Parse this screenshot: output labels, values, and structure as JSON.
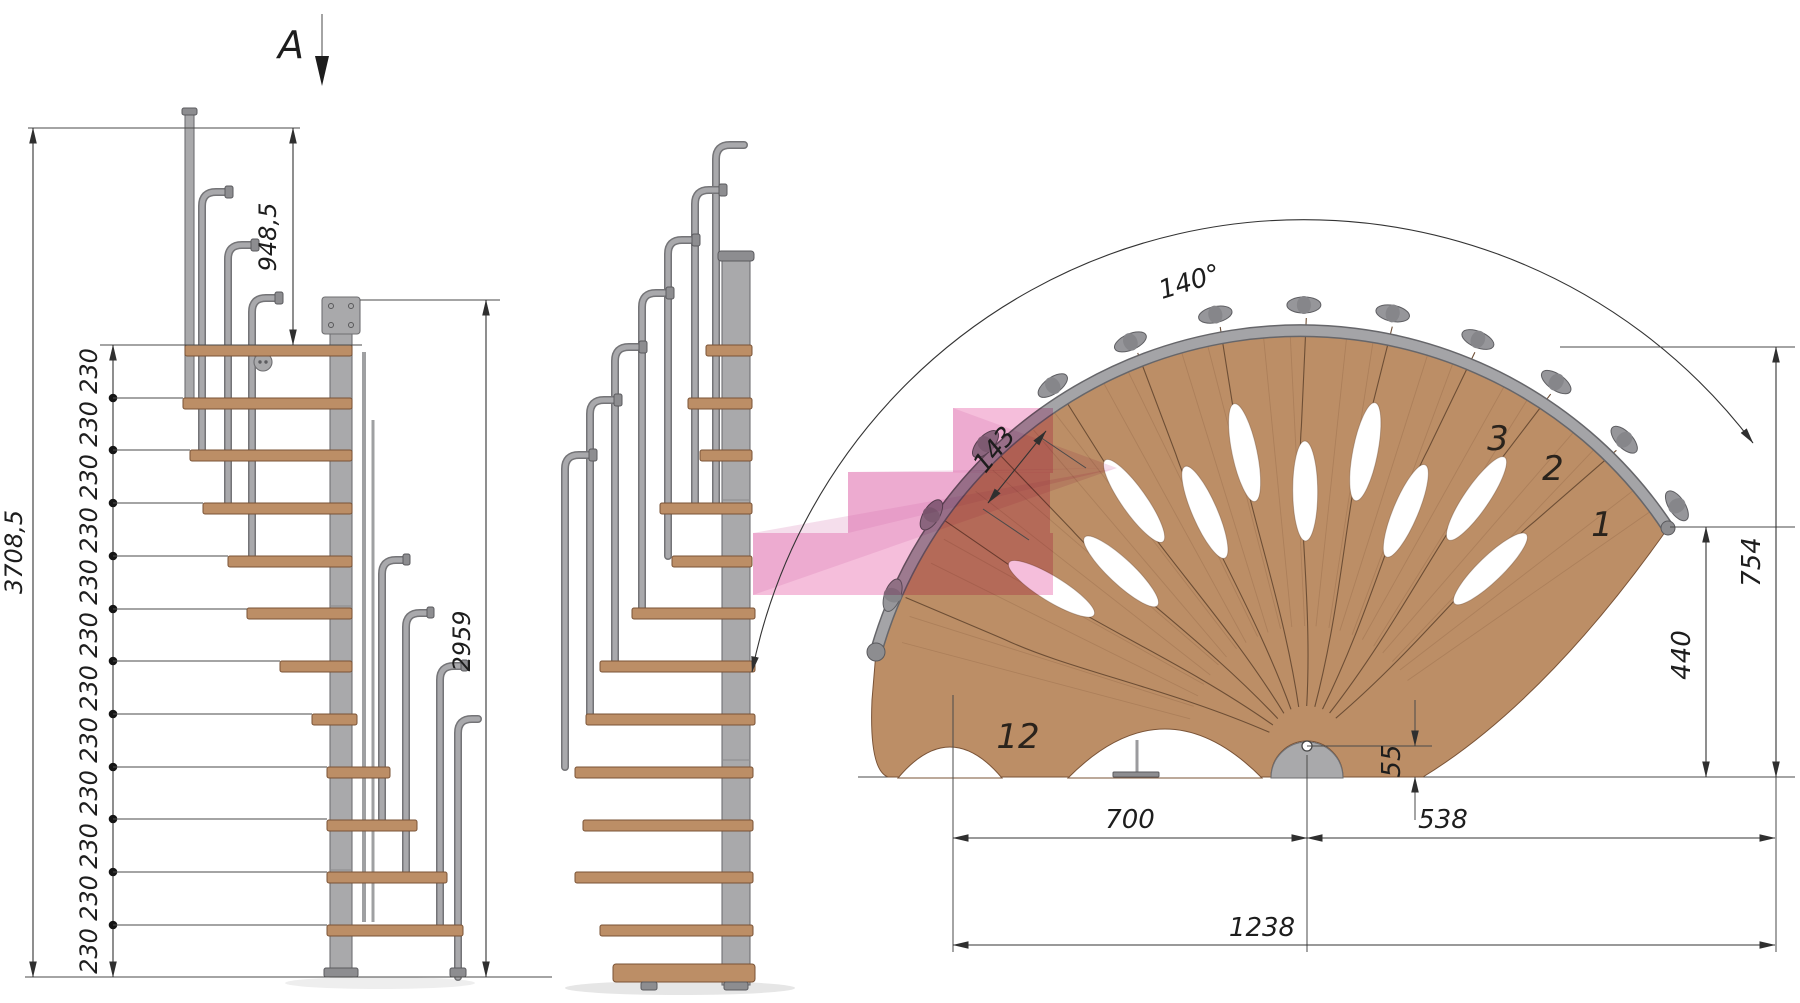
{
  "section_marker": {
    "label": "A"
  },
  "side_view": {
    "overall_height": "3708,5",
    "top_run_height": "948,5",
    "pole_height": "2959",
    "risers": [
      "230",
      "230",
      "230",
      "230",
      "230",
      "230",
      "230",
      "230",
      "230",
      "230",
      "230",
      "230"
    ]
  },
  "plan_view": {
    "rotation_angle": "140°",
    "step_outer_width": "143",
    "outer_radius": "754",
    "tread_depth": "440",
    "pole_offset": "55",
    "left_width": "700",
    "right_width": "538",
    "total_width": "1238",
    "step_numbers": {
      "first": "1",
      "second": "2",
      "third": "3",
      "last": "12"
    }
  },
  "colors": {
    "wood": "#bc8e66",
    "wood_edge": "#7a5336",
    "metal": "#a9a9ab",
    "metal_dark": "#6f6f72",
    "highlight_pink": "#f2aed2",
    "line": "#333333",
    "background": "#ffffff"
  }
}
